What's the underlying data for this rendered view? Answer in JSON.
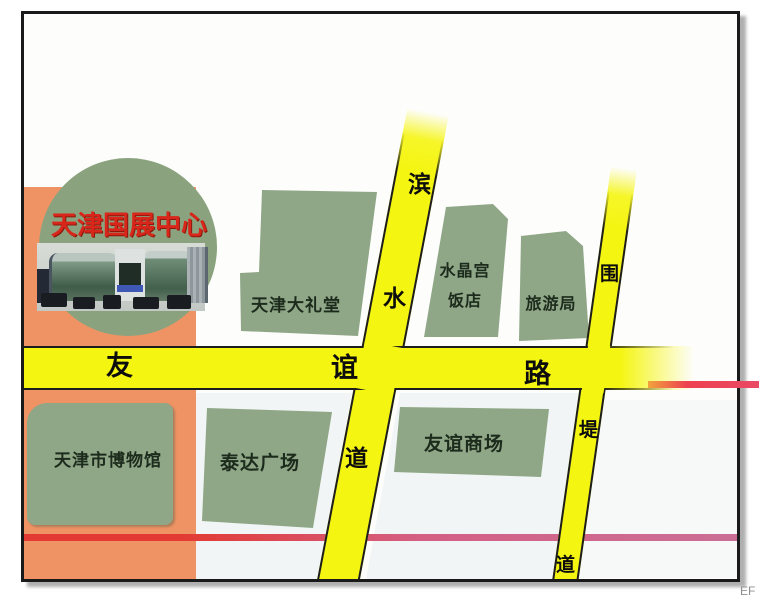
{
  "inset": {
    "title": "天津国展中心"
  },
  "blocks": {
    "dalitang": {
      "label": "天津大礼堂"
    },
    "shuijinggong": {
      "line1": "水晶宫",
      "line2": "饭店"
    },
    "lvyouju": {
      "label": "旅游局"
    },
    "bowuguan": {
      "label": "天津市博物馆"
    },
    "teda": {
      "label": "泰达广场"
    },
    "youyimall": {
      "label": "友谊商场"
    }
  },
  "roads": {
    "youyi": {
      "name": "友谊路",
      "chars": [
        "友",
        "谊",
        "路"
      ]
    },
    "binshui": {
      "name": "滨水道",
      "chars": [
        "滨",
        "水",
        "道"
      ]
    },
    "weidi": {
      "name": "围堤道",
      "chars": [
        "围",
        "堤",
        "道"
      ]
    }
  },
  "colors": {
    "road_yellow": "#f5f512",
    "block_green": "#8fa787",
    "circle_green": "#8aa37e",
    "orange_area": "#ef9364",
    "title_red": "#d8271a",
    "pink_line": "#d45f83",
    "red_line": "#ee4150"
  },
  "watermark": "EF"
}
